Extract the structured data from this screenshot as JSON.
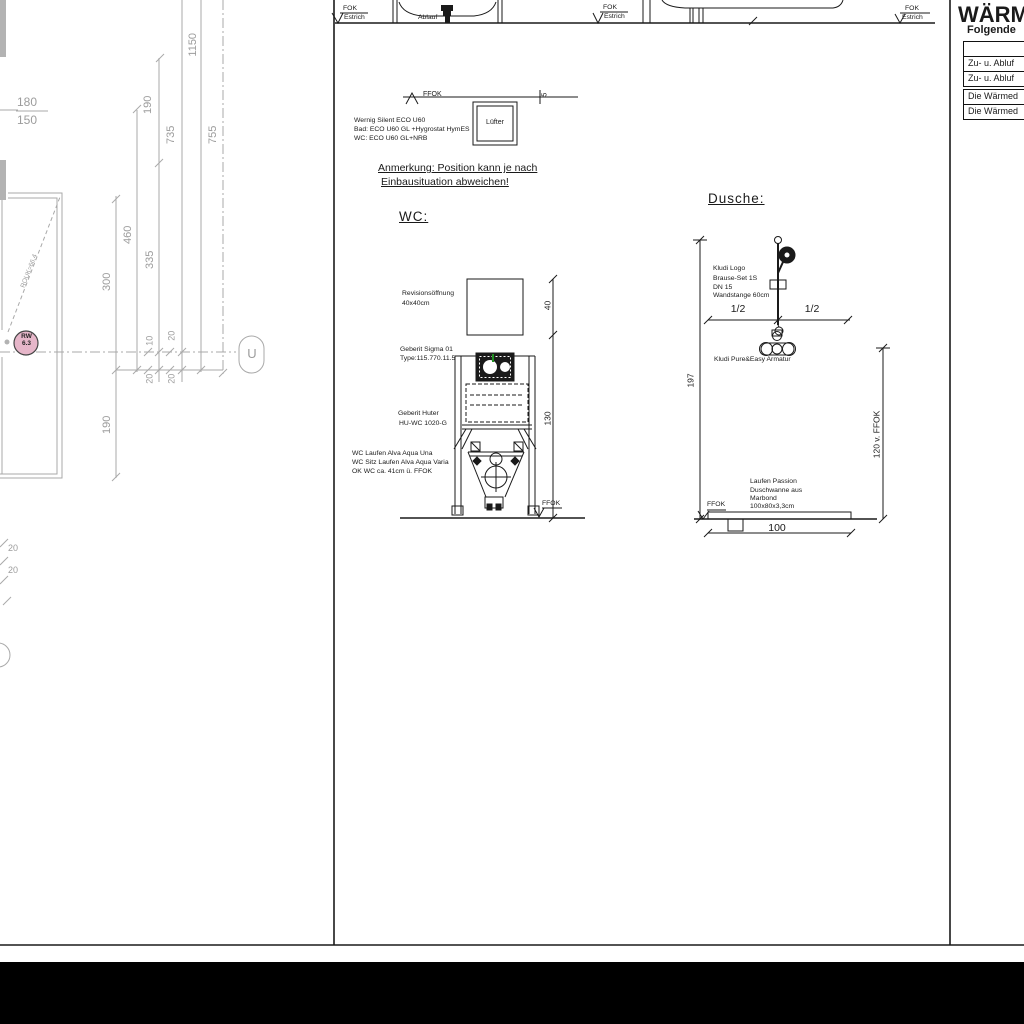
{
  "colors": {
    "line_black": "#1a1a1a",
    "line_gray": "#a9a9a9",
    "text_gray": "#9c9c9c",
    "rw_pink": "#e6b6c9",
    "green_mark": "#1f8f1f",
    "titlebar_black": "#000000"
  },
  "plan": {
    "dims": {
      "d180": "180",
      "d150": "150",
      "d1150": "1150",
      "d190a": "190",
      "d735": "735",
      "d755": "755",
      "d460": "460",
      "d335": "335",
      "d300": "300",
      "d190b": "190",
      "d10": "10",
      "d20ur": "20",
      "d20ll": "20",
      "d20lr": "20",
      "d20b1": "20",
      "d20b2": "20"
    },
    "rw_line1": "RW",
    "rw_line2": "6.3",
    "diag_label": "ROUK=66.4",
    "section_u": "U"
  },
  "top": {
    "fok": "FOK",
    "estrich": "Estrich",
    "ablauf": "Ablauf"
  },
  "wc": {
    "ffok_top": "FFOK",
    "dim5": "5",
    "luefter": "Lüfter",
    "fan_lines": [
      "Wernig Silent ECO U60",
      "Bad: ECO U60 GL +Hygrostat HymES",
      "WC: ECO U60 GL+NRB"
    ],
    "note1": "Anmerkung: Position kann je nach",
    "note2": "Einbausituation abweichen!",
    "heading": "WC:",
    "rev1": "Revisionsöffnung",
    "rev2": "40x40cm",
    "sigma1": "Geberit Sigma 01",
    "sigma2": "Type:115.770.11.5",
    "huter1": "Geberit Huter",
    "huter2": "HU-WC 1020-G",
    "wc1": "WC Laufen Alva Aqua Una",
    "wc2": "WC Sitz Laufen Alva Aqua Varia",
    "wc3": "OK WC ca. 41cm ü. FFOK",
    "dim40": "40",
    "dim130": "130",
    "ffok_bottom": "FFOK"
  },
  "dusche": {
    "heading": "Dusche:",
    "brause": [
      "Kludi Logo",
      "Brause-Set 1S",
      "DN 15",
      "Wandstange 60cm"
    ],
    "half_l": "1/2",
    "half_r": "1/2",
    "armatur": "Kludi Pure&Easy Armatur",
    "dim197": "197",
    "dim120": "120  v.  FFOK",
    "dim100": "100",
    "tray": [
      "Laufen Passion",
      "Duschwanne aus",
      "Marbond",
      "100x80x3,3cm"
    ],
    "ffok": "FFOK"
  },
  "panel": {
    "title": "WÄRM",
    "subtitle": "Folgende",
    "rows_top": [
      "",
      "Zu- u. Abluf",
      "Zu- u. Abluf"
    ],
    "rows_bottom": [
      "Die Wärmed",
      "Die Wärmed"
    ]
  }
}
